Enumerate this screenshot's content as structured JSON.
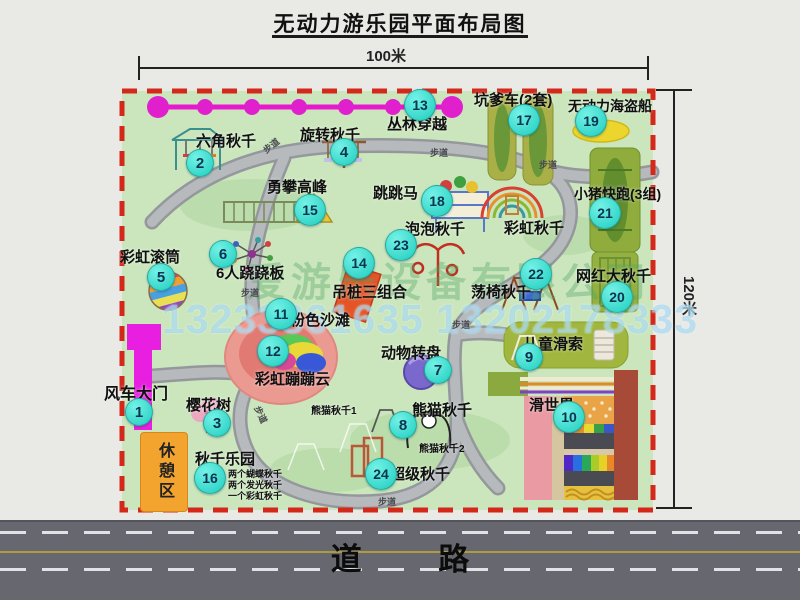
{
  "title": "无动力游乐园平面布局图",
  "dims": {
    "top": "100米",
    "right": "120米"
  },
  "road": {
    "label": "道  路"
  },
  "rest_area": {
    "label": "休憩区"
  },
  "watermark": {
    "company": "爱游乐设备有限公司",
    "phone": "13233861635 13202178333"
  },
  "attractions": [
    {
      "num": "1",
      "label": "风车大门"
    },
    {
      "num": "2",
      "label": "六角秋千"
    },
    {
      "num": "3",
      "label": "樱花树"
    },
    {
      "num": "4",
      "label": "旋转秋千"
    },
    {
      "num": "5",
      "label": "彩虹滚筒"
    },
    {
      "num": "6",
      "label": "6人跷跷板"
    },
    {
      "num": "7",
      "label": "动物转盘"
    },
    {
      "num": "8",
      "label": "熊猫秋千"
    },
    {
      "num": "9",
      "label": "儿童滑索"
    },
    {
      "num": "10",
      "label": "滑世界"
    },
    {
      "num": "11",
      "label": "粉色沙滩"
    },
    {
      "num": "12",
      "label": "彩虹蹦蹦云"
    },
    {
      "num": "13",
      "label": "丛林穿越"
    },
    {
      "num": "14",
      "label": "吊桩三组合"
    },
    {
      "num": "15",
      "label": "勇攀高峰"
    },
    {
      "num": "16",
      "label": "秋千乐园"
    },
    {
      "num": "17",
      "label": "坑爹车(2套)"
    },
    {
      "num": "18",
      "label": "跳跳马"
    },
    {
      "num": "19",
      "label": "无动力海盗船"
    },
    {
      "num": "20",
      "label": "网红大秋千"
    },
    {
      "num": "21",
      "label": "小猪快跑(3组)"
    },
    {
      "num": "22",
      "label": "荡椅秋千"
    },
    {
      "num": "23",
      "label": "泡泡秋千"
    },
    {
      "num": "24",
      "label": "超级秋千"
    }
  ],
  "sub_labels": {
    "rainbow_swing": "彩虹秋千",
    "panda1": "熊猫秋千1",
    "panda2": "熊猫秋千2"
  },
  "swing_park_notes": [
    "两个蝴蝶秋千",
    "两个发光秋千",
    "一个彩虹秋千"
  ],
  "path_labels": [
    "步道",
    "步道",
    "步道",
    "步道",
    "步道",
    "步道",
    "步道"
  ],
  "icons": {
    "zipline": "magenta dotted cable",
    "gate": "magenta windmill gate",
    "pirate_ship": "yellow ellipse pool",
    "rainbow_swing": "nested rainbow arcs",
    "pink_beach": "pink oval with rainbow cloud",
    "slide_world": "multicolor slide lanes"
  },
  "colors": {
    "park_green": "#cbe6bd",
    "border_red": "#d3281a",
    "badge_cyan": "#2fd9cf",
    "zipline_magenta": "#e818d0",
    "road_gray": "#67676f",
    "rest_orange": "#f2a42e"
  }
}
